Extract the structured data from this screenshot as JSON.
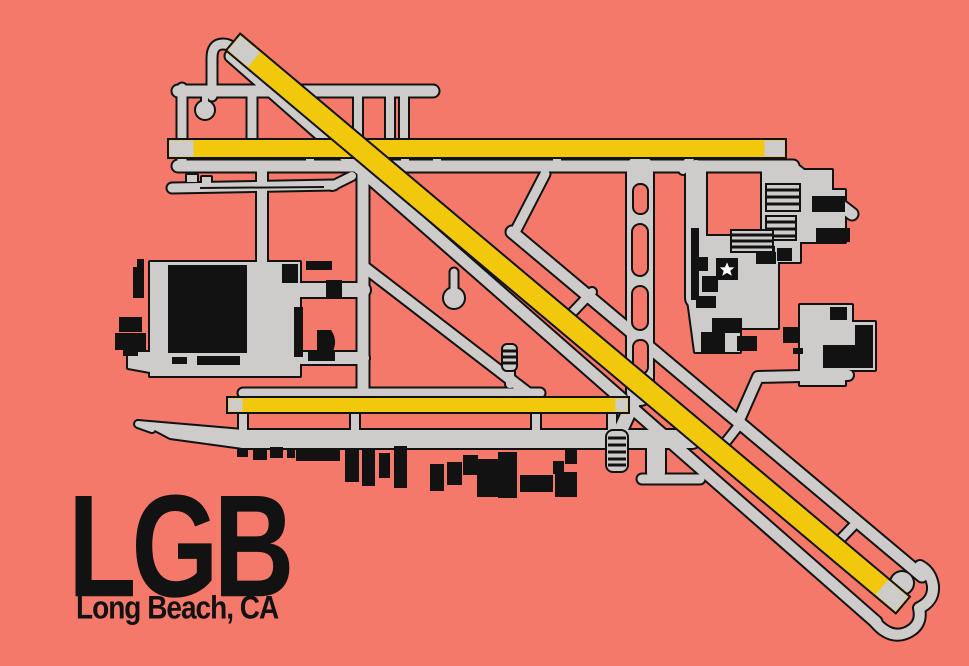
{
  "poster": {
    "airport_code": "LGB",
    "location": "Long Beach, CA"
  },
  "colors": {
    "background": "#f5796b",
    "pavement_gray": "#cdccca",
    "runway_yellow": "#f2c80d",
    "outline_black": "#121212",
    "building_black": "#121212",
    "star_white": "#ffffff"
  },
  "icons": {
    "star": "terminal-star-marker"
  }
}
